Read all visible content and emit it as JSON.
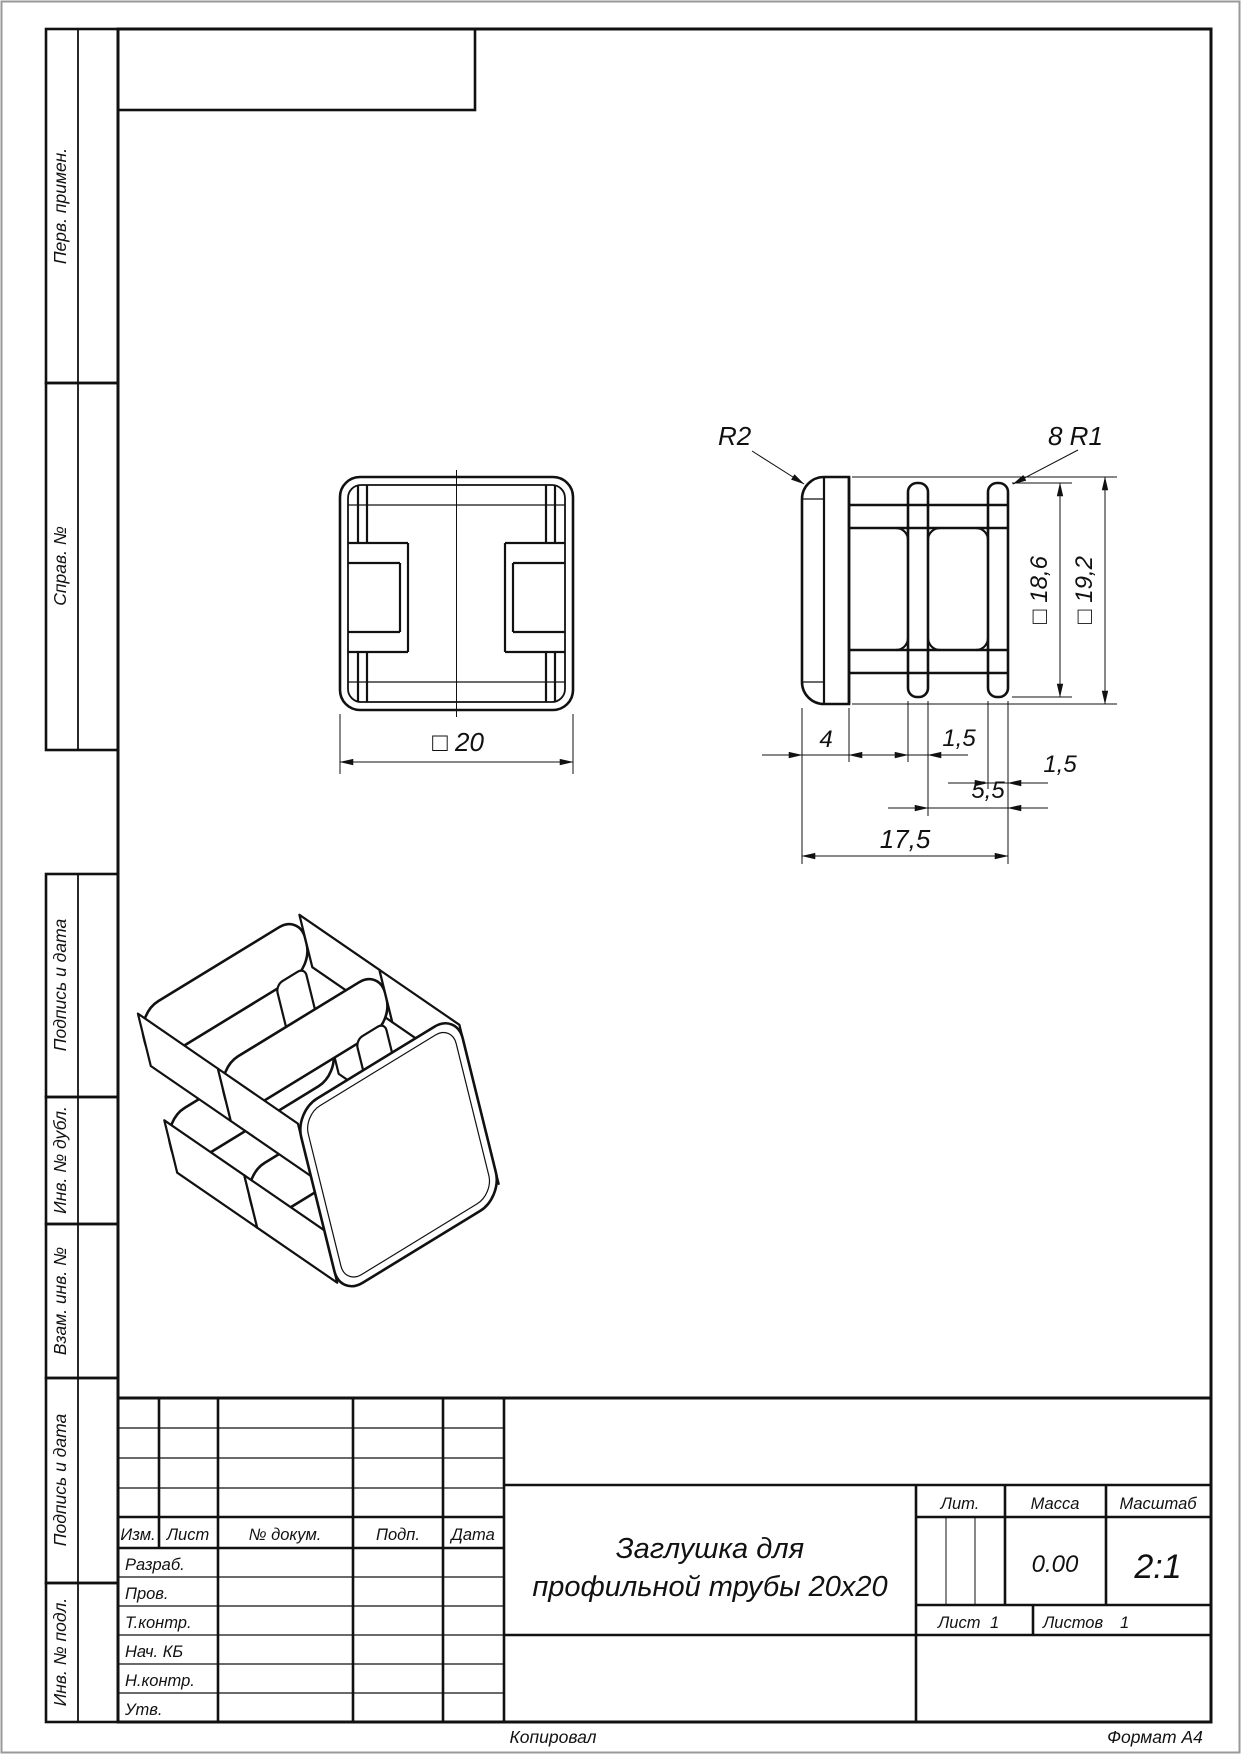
{
  "margin_column": {
    "sections": [
      {
        "label": "Перв. примен."
      },
      {
        "label": "Справ. №"
      },
      {
        "label": "Подпись и дата"
      },
      {
        "label": "Инв. № дубл."
      },
      {
        "label": "Взам. инв. №"
      },
      {
        "label": "Подпись и дата"
      },
      {
        "label": "Инв. № подл."
      }
    ]
  },
  "views": {
    "front": {
      "dim_width": "□ 20"
    },
    "side": {
      "radius_label": "R2",
      "fillet_label": "8  R1",
      "dim_body_height": "□ 18,6",
      "dim_flange_height": "□ 19,2",
      "dim_flange_width": "4",
      "dim_rib_mid": "1,5",
      "dim_rib_end": "1,5",
      "dim_rib_span": "5,5",
      "dim_total_length": "17,5"
    }
  },
  "title_block": {
    "revision_columns": {
      "izm": "Изм.",
      "sheet": "Лист",
      "doc_num": "№ докум.",
      "sign": "Подп.",
      "date": "Дата"
    },
    "approval_rows": {
      "developed": "Разраб.",
      "checked": "Пров.",
      "tech_control": "Т.контр.",
      "dept_head": "Нач. КБ",
      "norm_control": "Н.контр.",
      "approved": "Утв."
    },
    "title_line1": "Заглушка для",
    "title_line2": "профильной трубы 20x20",
    "lit_label": "Лит.",
    "mass_label": "Масса",
    "mass_value": "0.00",
    "scale_label": "Масштаб",
    "scale_value": "2:1",
    "sheet_label": "Лист",
    "sheet_number": "1",
    "sheets_label": "Листов",
    "sheets_total": "1"
  },
  "footer": {
    "copied_by": "Копировал",
    "format": "Формат A4"
  }
}
